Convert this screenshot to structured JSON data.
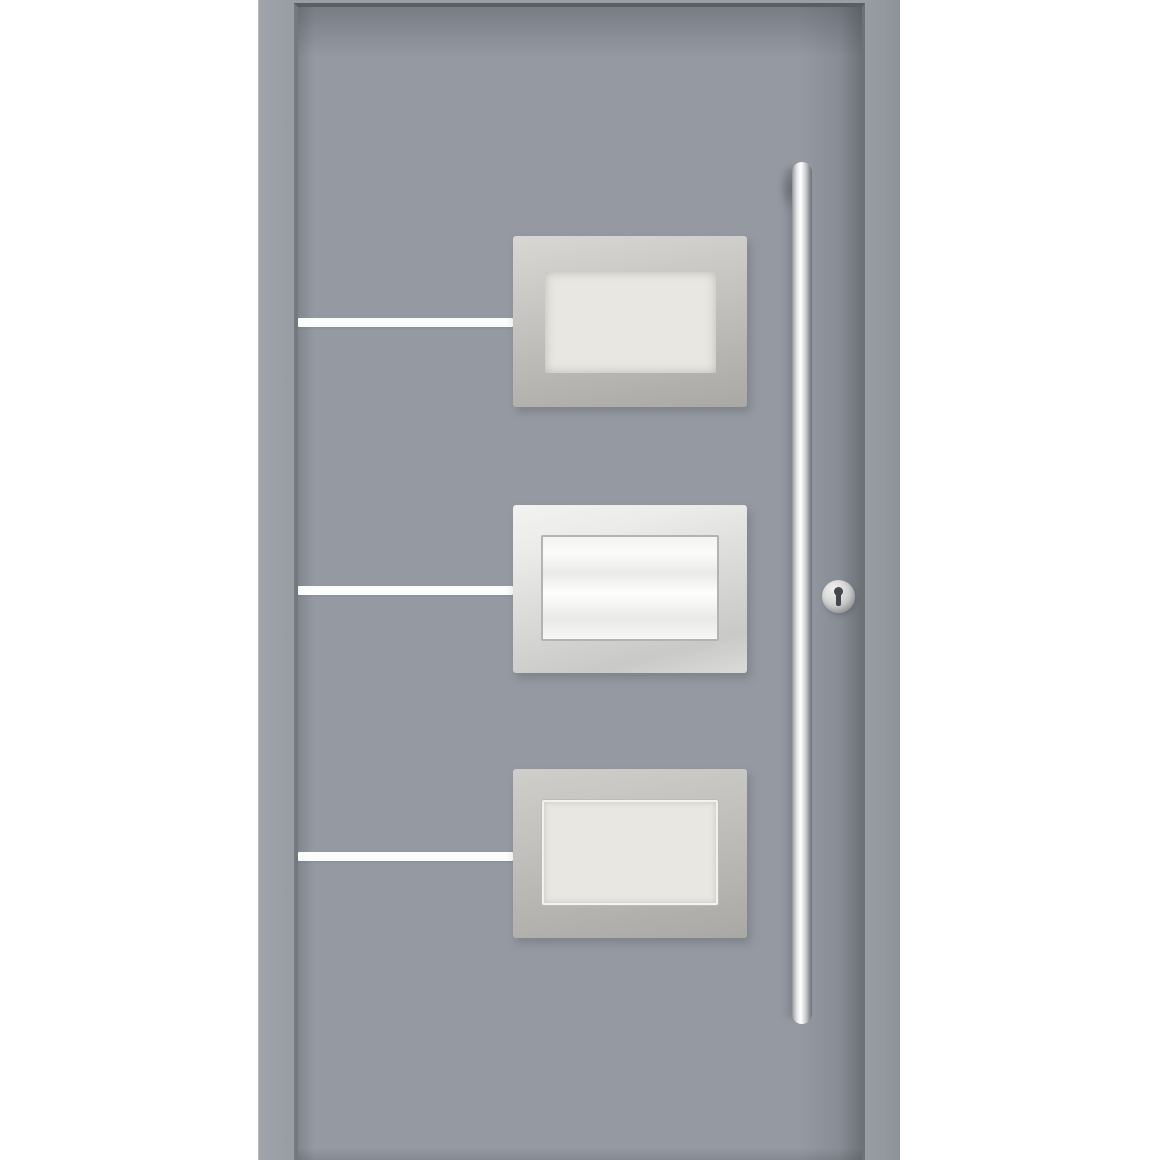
{
  "scene": {
    "type": "product-photo",
    "subject": "modern-front-entrance-door",
    "door_finish": "grey",
    "glass_panel_count": 3,
    "accent_line_count": 3,
    "hardware": {
      "handle": "vertical-stainless-bar-pull-handle",
      "lock": "round-cylinder-escutcheon-with-keyhole"
    },
    "glass_styles": [
      "frosted",
      "bright-white-with-trim-line",
      "frosted-with-white-outline"
    ]
  },
  "colors": {
    "bg": "#ffffff",
    "frame": "#999ea5",
    "frame_light": "#a0a5ac",
    "frame_edge": "#8d939a",
    "slab": "#959aa2",
    "seam_left": "#75797f",
    "seam_top": "#5a5e64",
    "seam_right": "#6e7277",
    "accent_line": "#fbfcfc",
    "steel_light": "#d8d7d4",
    "steel_mid": "#bcbbb8",
    "steel_dark": "#a9a8a5",
    "steel_bright": "#ebebe9",
    "glass_frosted": "#e8e7e2",
    "glass_bright": "#fbfbf9",
    "glass_outline": "#f3f2ef",
    "handle_light": "#ffffff",
    "handle_dark": "#6d7176",
    "lock_light": "#efefee",
    "lock_dark": "#9a9c9e",
    "keyhole": "#44474b"
  }
}
